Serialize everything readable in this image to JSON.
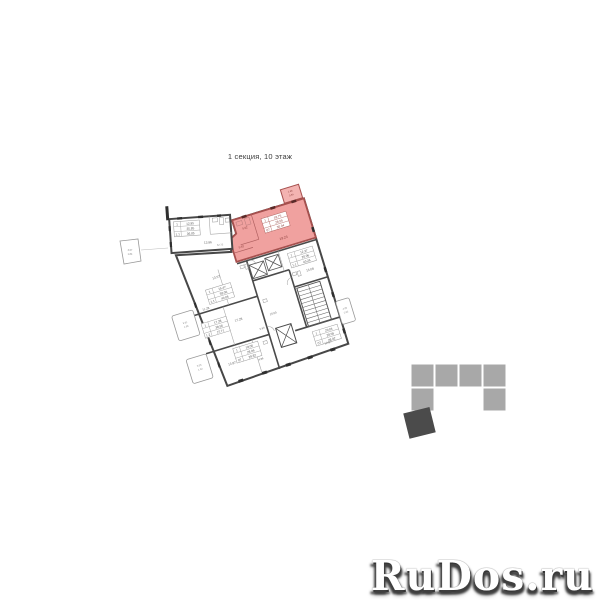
{
  "title": "1 секция, 10 этаж",
  "watermark": "RuDos.ru",
  "colors": {
    "highlight_fill": "#f0a19f",
    "highlight_stroke": "#a6504e",
    "wall": "#474747",
    "thin_wall": "#a9a9a9",
    "footprint_light": "#a8a8a8",
    "footprint_dark": "#4b4b4b"
  },
  "highlighted_apartment": {
    "rooms": "1",
    "living_area": "18.75",
    "floor_area": "28.55",
    "unit": "07",
    "total_area": "30.04",
    "room_label": "19.23",
    "balcony": "1.68 / 0.84"
  },
  "plan": {
    "tables": [
      {
        "layer": "b",
        "x": 174,
        "y": 220,
        "red": false,
        "rows": [
          [
            "1",
            "12.95"
          ],
          [
            "",
            "35.85"
          ],
          [
            "1.1",
            "36.85"
          ]
        ]
      },
      {
        "layer": "rot",
        "x": 284,
        "y": 227,
        "red": true,
        "rows": [
          [
            "1",
            "18.75"
          ],
          [
            "",
            "28.55"
          ],
          [
            "07",
            "30.04"
          ]
        ]
      },
      {
        "layer": "rot",
        "x": 299,
        "y": 268,
        "red": false,
        "rows": [
          [
            "1",
            "12.37"
          ],
          [
            "",
            "20.06"
          ],
          [
            "1.1",
            "40.26"
          ]
        ]
      },
      {
        "layer": "rot",
        "x": 210,
        "y": 279,
        "red": false,
        "rows": [
          [
            "1",
            "15.47"
          ],
          [
            "",
            "38.06"
          ],
          [
            "1.1",
            "40.06"
          ]
        ]
      },
      {
        "layer": "rot",
        "x": 196,
        "y": 310,
        "red": false,
        "rows": [
          [
            "1",
            "17.38"
          ],
          [
            "",
            "38.56"
          ],
          [
            "1.2",
            "27.71"
          ]
        ]
      },
      {
        "layer": "rot",
        "x": 219,
        "y": 343,
        "red": false,
        "rows": [
          [
            "1",
            "18.06"
          ],
          [
            "",
            "28.06"
          ],
          [
            "07",
            "29.82"
          ]
        ]
      },
      {
        "layer": "rot",
        "x": 300,
        "y": 350,
        "red": false,
        "rows": [
          [
            "1",
            "20.04"
          ],
          [
            "",
            "28.05"
          ],
          [
            "07",
            "28.92"
          ]
        ]
      }
    ],
    "labels": [
      {
        "layer": "rot",
        "x": 300,
        "y": 253,
        "t": "19.23",
        "c": "#8a3f3c",
        "s": 3.4
      },
      {
        "layer": "rot",
        "x": 257,
        "y": 249,
        "t": "5.92",
        "c": "#8a3f3c",
        "s": 2.8
      },
      {
        "layer": "rot",
        "x": 266,
        "y": 232,
        "t": "5.02",
        "c": "#8a3f3c",
        "s": 2.8
      },
      {
        "layer": "rot",
        "x": 320,
        "y": 210,
        "t": "1.68",
        "c": "#8a3f3c",
        "s": 2.4
      },
      {
        "layer": "rot",
        "x": 320,
        "y": 214,
        "t": "0.84",
        "c": "#8a3f3c",
        "s": 2.4
      },
      {
        "layer": "rot",
        "x": 224,
        "y": 271,
        "t": "13.57",
        "s": 3.2
      },
      {
        "layer": "rot",
        "x": 205,
        "y": 298,
        "t": "11.28",
        "s": 3.0
      },
      {
        "layer": "rot",
        "x": 233,
        "y": 318,
        "t": "17.28",
        "s": 3.2
      },
      {
        "layer": "rot",
        "x": 214,
        "y": 358,
        "t": "13.87",
        "s": 3.2
      },
      {
        "layer": "rot",
        "x": 316,
        "y": 291,
        "t": "13.08",
        "s": 3.2
      },
      {
        "layer": "rot",
        "x": 312,
        "y": 366,
        "t": "12.87",
        "s": 3.0
      },
      {
        "layer": "rot",
        "x": 268,
        "y": 322,
        "t": "15.00",
        "s": 2.8
      },
      {
        "layer": "rot",
        "x": 243,
        "y": 362,
        "t": "4.86",
        "s": 2.6
      },
      {
        "layer": "rot",
        "x": 253,
        "y": 333,
        "t": "5.63",
        "s": 2.6
      },
      {
        "layer": "rot",
        "x": 181,
        "y": 305,
        "t": "3.91",
        "s": 2.4,
        "c": "#888888"
      },
      {
        "layer": "rot",
        "x": 181,
        "y": 309,
        "t": "1.96",
        "s": 2.4,
        "c": "#888888"
      },
      {
        "layer": "rot",
        "x": 182,
        "y": 350,
        "t": "3.08",
        "s": 2.4,
        "c": "#888888"
      },
      {
        "layer": "rot",
        "x": 182,
        "y": 354,
        "t": "1.54",
        "s": 2.4,
        "c": "#888888"
      },
      {
        "layer": "rot",
        "x": 338,
        "y": 338,
        "t": "4.05",
        "s": 2.4,
        "c": "#888888"
      },
      {
        "layer": "rot",
        "x": 338,
        "y": 342,
        "t": "2.03",
        "s": 2.4,
        "c": "#888888"
      },
      {
        "layer": "b",
        "x": 207,
        "y": 244,
        "t": "13.86",
        "s": 3.2
      },
      {
        "layer": "b",
        "x": 219,
        "y": 247,
        "t": "62.75",
        "s": 2.5,
        "c": "#888888"
      },
      {
        "layer": "flat",
        "x": 130,
        "y": 251,
        "t": "3.67",
        "s": 2.4,
        "c": "#888888"
      },
      {
        "layer": "flat",
        "x": 130,
        "y": 255,
        "t": "1.84",
        "s": 2.4,
        "c": "#888888"
      }
    ]
  },
  "footprint": {
    "square_size": 23,
    "light_squares": [
      {
        "x": 411,
        "y": 364
      },
      {
        "x": 435,
        "y": 364
      },
      {
        "x": 459,
        "y": 364
      },
      {
        "x": 483,
        "y": 364
      },
      {
        "x": 411,
        "y": 388
      },
      {
        "x": 483,
        "y": 388
      }
    ],
    "section_square": {
      "x": 406,
      "y": 410,
      "w": 27,
      "h": 26,
      "rotate": -14,
      "cx": 419,
      "cy": 423
    }
  }
}
